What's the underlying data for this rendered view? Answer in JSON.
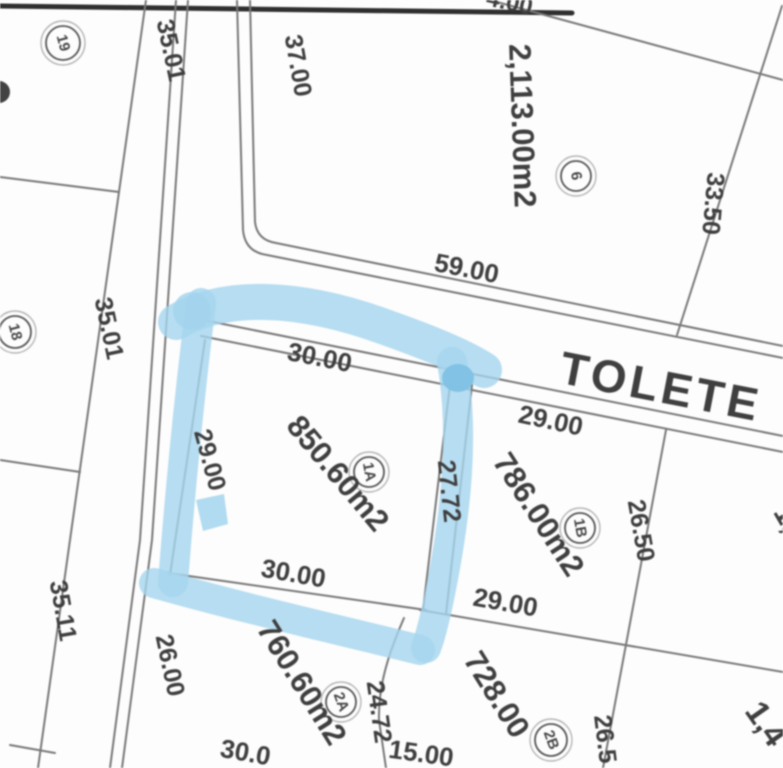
{
  "map": {
    "street_name": "TOLETE",
    "highlight_color": "#a6d8f2",
    "line_color": "#787878",
    "text_color": "#3c3c3c",
    "highlighted_lot": {
      "id": "1A",
      "area": "850.60m2"
    },
    "lots": [
      {
        "id": "19"
      },
      {
        "id": "18"
      },
      {
        "id": "6",
        "area": "2,113.00m2",
        "frontage": "59.00",
        "left_side": "37.00",
        "right_side": "33.50"
      },
      {
        "id": "1A",
        "area": "850.60m2",
        "top": "30.00",
        "bottom": "30.00",
        "left": "29.00",
        "right": "27.72",
        "highlighted": true
      },
      {
        "id": "1B",
        "area": "786.00m2",
        "top": "29.00",
        "bottom": "29.00",
        "right": "26.50"
      },
      {
        "id": "2A",
        "area": "760.60m2",
        "left": "26.00",
        "right": "24.72"
      },
      {
        "id": "2B",
        "area": "728.00"
      }
    ],
    "road_labels": [
      "35.01",
      "35.01",
      "35.11"
    ],
    "labels": [
      {
        "t": "TOLETE",
        "x": 658,
        "y": 402,
        "r": 11,
        "s": 46,
        "w": 600,
        "ls": 4,
        "role": "street-name"
      },
      {
        "t": "2,113.00m2",
        "x": 512,
        "y": 126,
        "r": 88,
        "s": 31,
        "w": 700,
        "role": "area-label-lot-6"
      },
      {
        "t": "850.60m2",
        "x": 330,
        "y": 480,
        "r": 50,
        "s": 31,
        "w": 700,
        "role": "area-label-lot-1a"
      },
      {
        "t": "786.00m2",
        "x": 530,
        "y": 520,
        "r": 57,
        "s": 31,
        "w": 700,
        "role": "area-label-lot-1b"
      },
      {
        "t": "760.60m2",
        "x": 293,
        "y": 688,
        "r": 58,
        "s": 31,
        "w": 700,
        "role": "area-label-lot-2a"
      },
      {
        "t": "728.00",
        "x": 488,
        "y": 700,
        "r": 58,
        "s": 31,
        "w": 700,
        "role": "area-label-lot-2b"
      },
      {
        "t": "1,4",
        "x": 757,
        "y": 730,
        "r": 55,
        "s": 33,
        "w": 700,
        "role": "partial-area-label"
      },
      {
        "t": "1,",
        "x": 779,
        "y": 523,
        "r": 60,
        "s": 30,
        "w": 700,
        "role": "partial-area-label"
      },
      {
        "t": "35.01",
        "x": 163,
        "y": 52,
        "r": 78,
        "s": 25,
        "role": "road-dimension"
      },
      {
        "t": "37.00",
        "x": 290,
        "y": 67,
        "r": 80,
        "s": 25,
        "role": "dimension-label"
      },
      {
        "t": "33.50",
        "x": 705,
        "y": 203,
        "r": 95,
        "s": 25,
        "role": "dimension-label"
      },
      {
        "t": "4.00",
        "x": 508,
        "y": 10,
        "r": 12,
        "s": 24,
        "role": "partial-dimension"
      },
      {
        "t": "59.00",
        "x": 465,
        "y": 277,
        "r": 11,
        "s": 26,
        "role": "dimension-label"
      },
      {
        "t": "35.01",
        "x": 101,
        "y": 330,
        "r": 78,
        "s": 25,
        "role": "road-dimension"
      },
      {
        "t": "30.00",
        "x": 318,
        "y": 366,
        "r": 11,
        "s": 26,
        "role": "dimension-label"
      },
      {
        "t": "29.00",
        "x": 549,
        "y": 429,
        "r": 12,
        "s": 26,
        "role": "dimension-label"
      },
      {
        "t": "29.00",
        "x": 202,
        "y": 462,
        "r": 75,
        "s": 25,
        "role": "dimension-label"
      },
      {
        "t": "27.72",
        "x": 441,
        "y": 492,
        "r": 84,
        "s": 25,
        "role": "dimension-label"
      },
      {
        "t": "26.50",
        "x": 633,
        "y": 532,
        "r": 80,
        "s": 25,
        "role": "dimension-label"
      },
      {
        "t": "30.00",
        "x": 292,
        "y": 582,
        "r": 10,
        "s": 26,
        "role": "dimension-label"
      },
      {
        "t": "29.00",
        "x": 504,
        "y": 611,
        "r": 10,
        "s": 26,
        "role": "dimension-label"
      },
      {
        "t": "35.11",
        "x": 55,
        "y": 612,
        "r": 80,
        "s": 25,
        "role": "road-dimension"
      },
      {
        "t": "26.00",
        "x": 162,
        "y": 667,
        "r": 78,
        "s": 25,
        "role": "dimension-label"
      },
      {
        "t": "24.72",
        "x": 371,
        "y": 713,
        "r": 82,
        "s": 25,
        "role": "dimension-label"
      },
      {
        "t": "26.5",
        "x": 597,
        "y": 740,
        "r": 83,
        "s": 25,
        "role": "partial-dimension"
      },
      {
        "t": "30.0",
        "x": 244,
        "y": 761,
        "r": 10,
        "s": 26,
        "role": "partial-dimension"
      },
      {
        "t": "15.00",
        "x": 420,
        "y": 762,
        "r": 8,
        "s": 26,
        "role": "partial-dimension"
      }
    ],
    "markers": [
      {
        "n": "19",
        "x": 63,
        "y": 43,
        "rad": 17,
        "rot": 75
      },
      {
        "n": "18",
        "x": 15,
        "y": 332,
        "rad": 16,
        "rot": 75
      },
      {
        "n": "6",
        "x": 576,
        "y": 176,
        "rad": 15,
        "rot": 80
      },
      {
        "n": "1A",
        "x": 369,
        "y": 472,
        "rad": 15,
        "rot": 80
      },
      {
        "n": "1B",
        "x": 580,
        "y": 528,
        "rad": 15,
        "rot": 80
      },
      {
        "n": "2A",
        "x": 341,
        "y": 702,
        "rad": 15,
        "rot": 70
      },
      {
        "n": "2B",
        "x": 551,
        "y": 740,
        "rad": 16,
        "rot": 70
      }
    ]
  }
}
